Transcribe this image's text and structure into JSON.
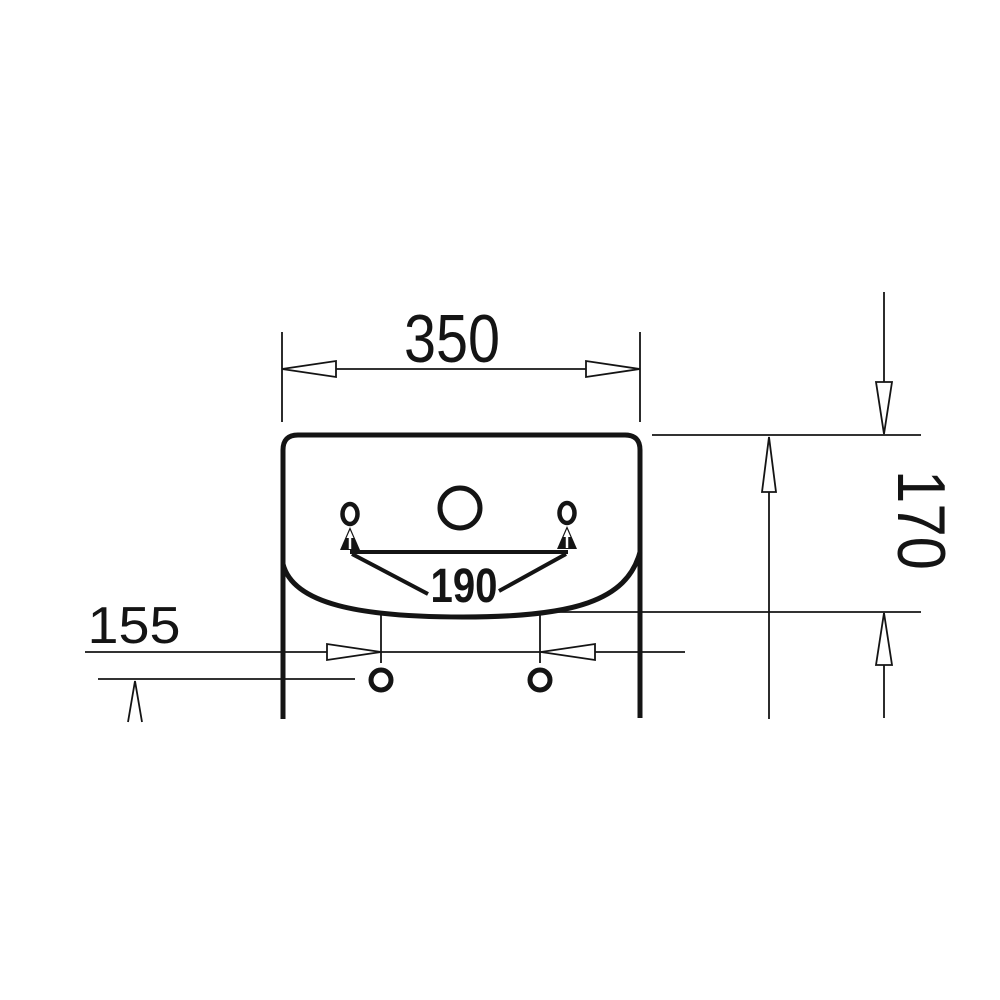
{
  "drawing": {
    "type": "technical-dimension-drawing",
    "subject": "wall-hung washbasin front view with pedestal, tap hole, overflow holes and fixing holes",
    "dimensions": {
      "top_width": "350",
      "right_height": "170",
      "left_offset": "155",
      "hole_spacing": "190"
    },
    "colors": {
      "line": "#141414",
      "background": "#ffffff"
    }
  }
}
